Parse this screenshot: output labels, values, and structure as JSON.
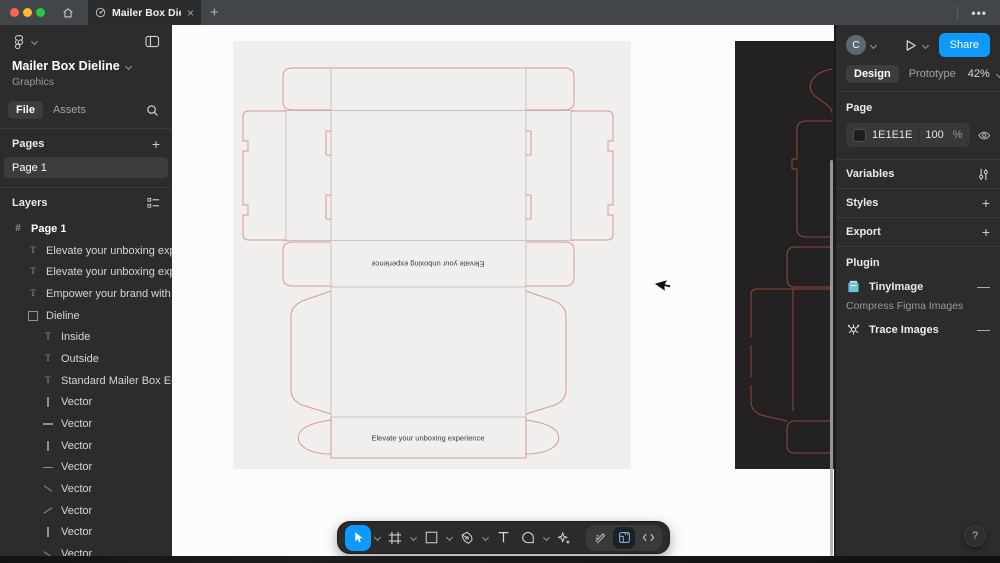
{
  "window": {
    "tab_title": "Mailer Box Dieline",
    "close_glyph": "×",
    "new_tab_glyph": "+",
    "overflow_glyph": "•••"
  },
  "left_panel": {
    "file_title": "Mailer Box Dieline",
    "file_subtitle": "Graphics",
    "tab_file": "File",
    "tab_assets": "Assets",
    "pages_header": "Pages",
    "add_glyph": "+",
    "pages": [
      {
        "name": "Page 1",
        "selected": true
      }
    ],
    "layers_header": "Layers",
    "layers": [
      {
        "icon": "frame",
        "label": "Page 1",
        "indent": 0,
        "bold": true
      },
      {
        "icon": "text",
        "label": "Elevate your unboxing experience",
        "indent": 1
      },
      {
        "icon": "text",
        "label": "Elevate your unboxing experience",
        "indent": 1
      },
      {
        "icon": "text",
        "label": "Empower your brand with custom",
        "indent": 1
      },
      {
        "icon": "rect",
        "label": "Dieline",
        "indent": 1
      },
      {
        "icon": "text",
        "label": "Inside",
        "indent": 2
      },
      {
        "icon": "text",
        "label": "Outside",
        "indent": 2
      },
      {
        "icon": "text",
        "label": "Standard Mailer Box E-flute (",
        "indent": 2
      },
      {
        "icon": "vline",
        "label": "Vector",
        "indent": 2
      },
      {
        "icon": "hline",
        "label": "Vector",
        "indent": 2
      },
      {
        "icon": "vline",
        "label": "Vector",
        "indent": 2
      },
      {
        "icon": "hline",
        "label": "Vector",
        "indent": 2
      },
      {
        "icon": "dline",
        "label": "Vector",
        "indent": 2
      },
      {
        "icon": "dline2",
        "label": "Vector",
        "indent": 2
      },
      {
        "icon": "vline",
        "label": "Vector",
        "indent": 2
      },
      {
        "icon": "dline",
        "label": "Vector",
        "indent": 2
      },
      {
        "icon": "dline2",
        "label": "Vector",
        "indent": 2
      }
    ]
  },
  "canvas": {
    "artboard_text_rotated": "Elevate your unboxing experience",
    "artboard_text_bottom": "Elevate your unboxing experience"
  },
  "toolbar": {
    "tools": [
      "move",
      "frame",
      "shape",
      "pen",
      "text",
      "comment",
      "actions",
      "draw",
      "dev-mode",
      "code"
    ]
  },
  "right_panel": {
    "avatar_initial": "C",
    "share_label": "Share",
    "tab_design": "Design",
    "tab_prototype": "Prototype",
    "zoom_value": "42%",
    "page_section": {
      "label": "Page",
      "color_hex": "1E1E1E",
      "opacity_value": "100",
      "opacity_unit": "%"
    },
    "variables_label": "Variables",
    "styles_label": "Styles",
    "export_label": "Export",
    "add_glyph": "+",
    "plugin_header": "Plugin",
    "plugins": [
      {
        "name": "TinyImage",
        "description": "Compress Figma Images"
      },
      {
        "name": "Trace Images"
      }
    ],
    "remove_glyph": "—",
    "help_glyph": "?"
  },
  "colors": {
    "accent": "#0d99ff",
    "panel": "#2c2c2c",
    "titlebar": "#42464a",
    "canvas_bg": "#fcfcfc",
    "artboard_light": "#f0efee",
    "artboard_dark": "#242122",
    "dieline_cut": "#d89a8c",
    "dieline_fold": "#c7c3c0",
    "dieline_dark_cut": "#8f4c3c",
    "page_color": "#1e1e1e"
  }
}
